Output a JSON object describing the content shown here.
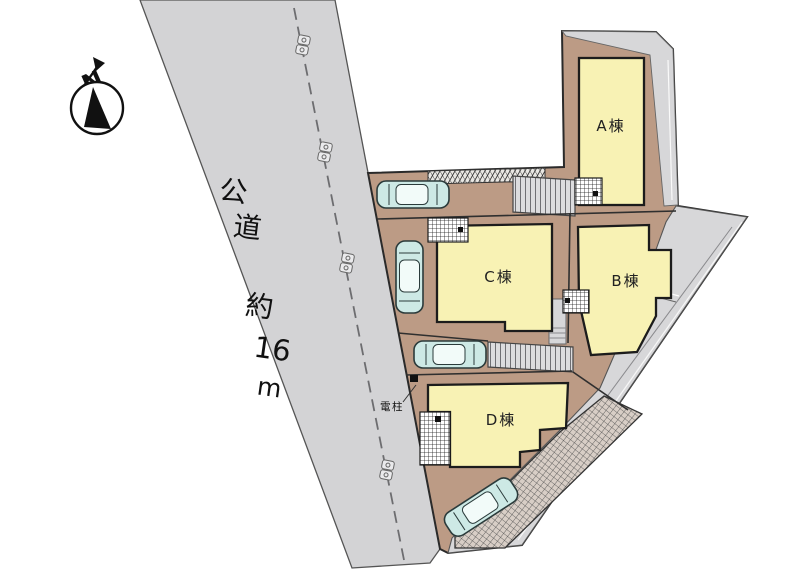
{
  "compass": {
    "label": "N"
  },
  "road": {
    "full_label": "公道 約16m",
    "label_chars": [
      "公",
      "道",
      "約",
      "16",
      "m"
    ]
  },
  "buildings": [
    {
      "id": "a",
      "label": "A棟"
    },
    {
      "id": "b",
      "label": "B棟"
    },
    {
      "id": "c",
      "label": "C棟"
    },
    {
      "id": "d",
      "label": "D棟"
    }
  ],
  "annotations": {
    "utility_pole": "電柱"
  },
  "colors": {
    "road": "#d3d3d5",
    "land": "#bc9b85",
    "building": "#f8f2b4",
    "band": "#d7d7d9",
    "car": "#cde9e5",
    "outline": "#2a2a2a"
  }
}
